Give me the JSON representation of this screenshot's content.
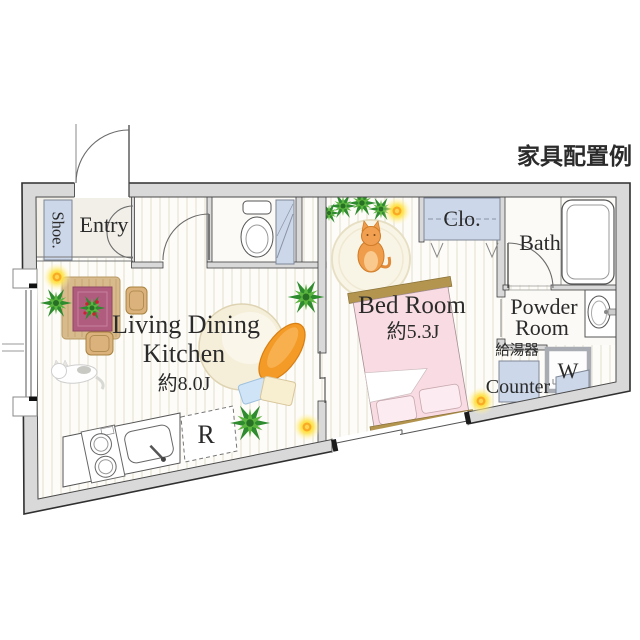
{
  "title": "家具配置例",
  "labels": {
    "shoe": "Shoe.",
    "entry": "Entry",
    "closet": "Clo.",
    "bath": "Bath",
    "powder_line1": "Powder",
    "powder_line2": "Room",
    "water_heater": "給湯器",
    "washer": "W",
    "counter": "Counter",
    "refrigerator": "R",
    "ldk_line1": "Living Dining",
    "ldk_line2": "Kitchen",
    "ldk_area": "約8.0J",
    "bedroom": "Bed Room",
    "bedroom_area": "約5.3J"
  },
  "colors": {
    "wall_fill": "#d9d9d9",
    "closet_fill": "#ccd7e9",
    "wood_accent": "#b3954f",
    "bed_pink": "#f9dce3",
    "cushion_orange": "#f49a26",
    "plant_green": "#2e8b2e",
    "sun_yellow": "#ffd000"
  }
}
